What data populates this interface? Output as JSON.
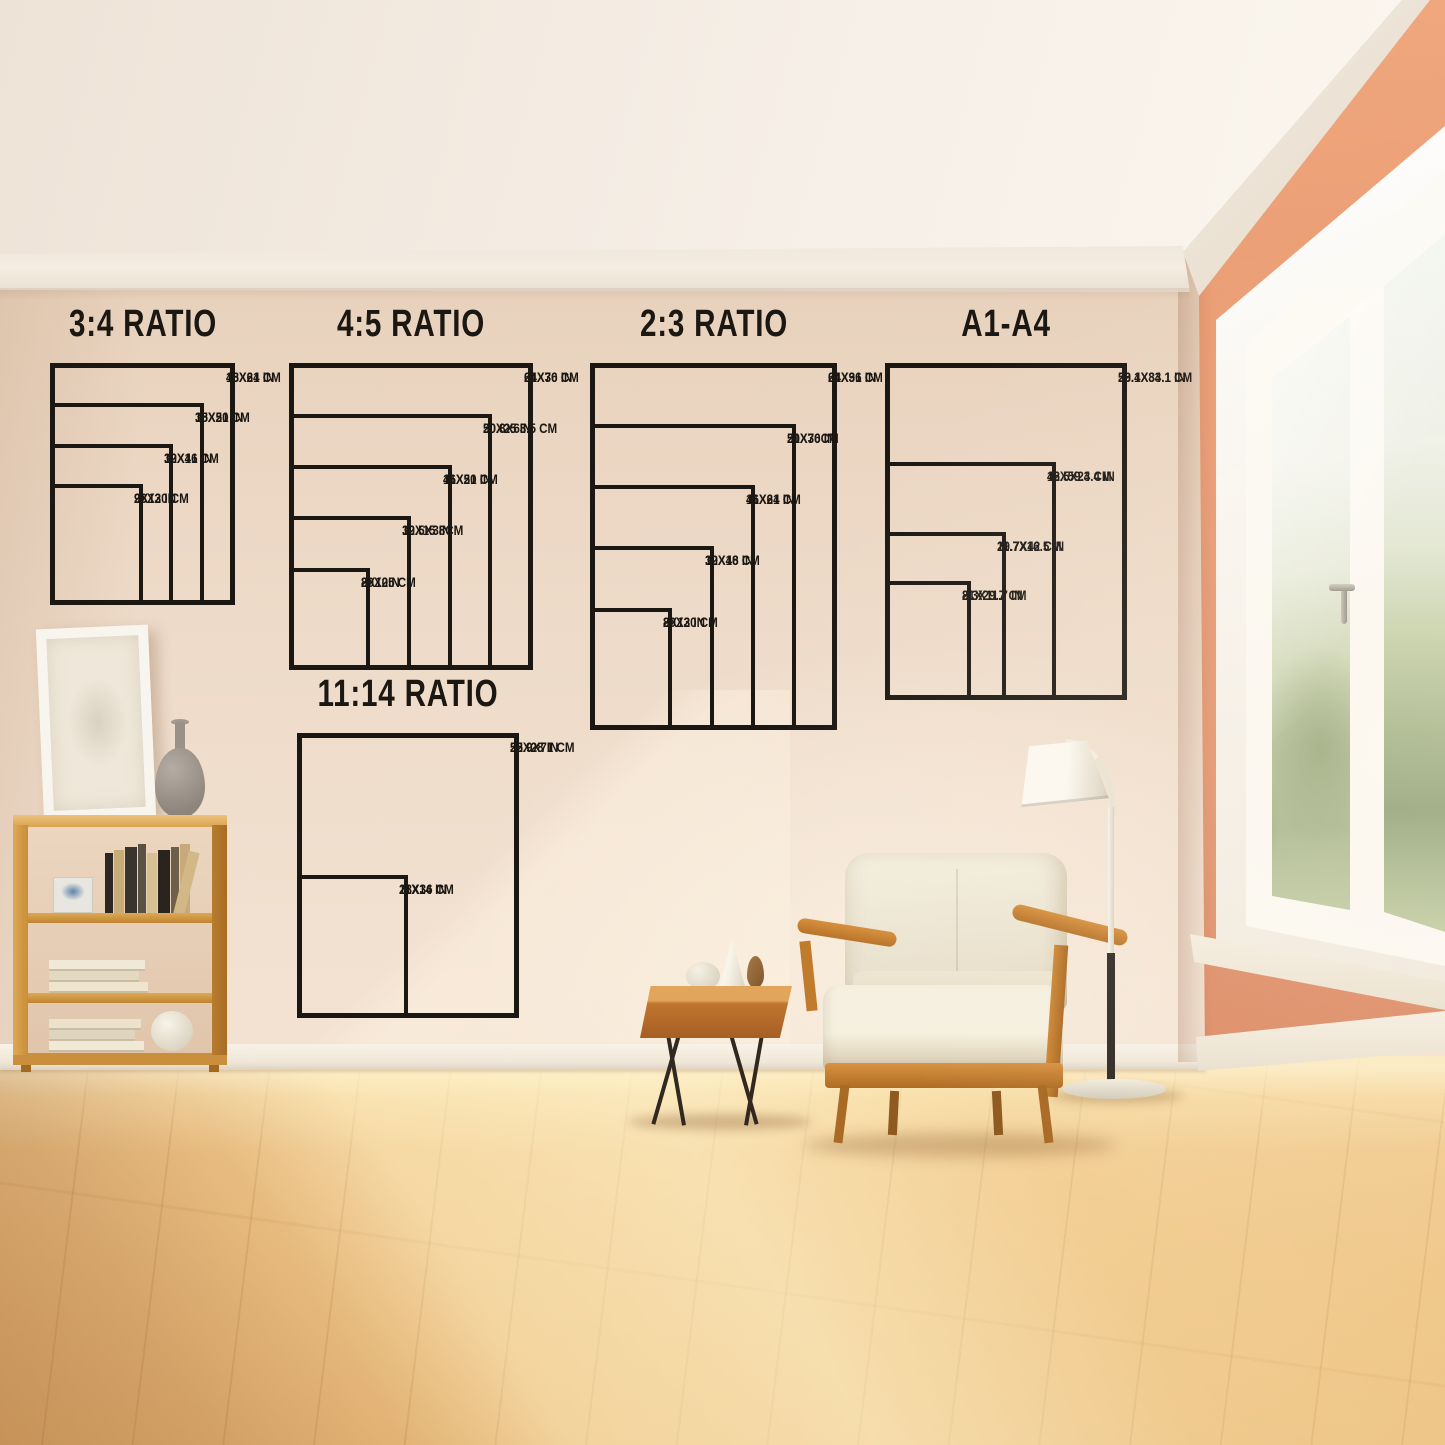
{
  "page_type": "poster-size-guide-room-mockup",
  "colors": {
    "ink": "#1b1713",
    "wall_cream": "#eedbc9",
    "wall_peach": "#e89a72",
    "floor_wood": "#edc287",
    "furniture_wood": "#c9812f",
    "cushion": "#f2ecdc",
    "window_green": "#a9b88e"
  },
  "chart_data": [
    {
      "type": "nested-size-diagram",
      "title": "3:4 RATIO",
      "sizes": [
        {
          "label_in": "18X24 IN",
          "label_cm": "46X61 CM",
          "w": 18,
          "h": 24
        },
        {
          "label_in": "15X20 IN",
          "label_cm": "38X51 CM",
          "w": 15,
          "h": 20
        },
        {
          "label_in": "12X16 IN",
          "label_cm": "30X41 CM",
          "w": 12,
          "h": 16
        },
        {
          "label_in": "9X12 IN",
          "label_cm": "23X30 CM",
          "w": 9,
          "h": 12
        }
      ]
    },
    {
      "type": "nested-size-diagram",
      "title": "4:5 RATIO",
      "sizes": [
        {
          "label_in": "24X30 IN",
          "label_cm": "61X76 CM",
          "w": 24,
          "h": 30
        },
        {
          "label_in": "20X25 IN",
          "label_cm": "50.8X63.5 CM",
          "w": 20,
          "h": 25
        },
        {
          "label_in": "16X20 IN",
          "label_cm": "41X51 CM",
          "w": 16,
          "h": 20
        },
        {
          "label_in": "12X15 IN",
          "label_cm": "30.5X38CM",
          "w": 12,
          "h": 15
        },
        {
          "label_in": "8X10IN",
          "label_cm": "20X25 CM",
          "w": 8,
          "h": 10
        }
      ]
    },
    {
      "type": "nested-size-diagram",
      "title": "2:3 RATIO",
      "sizes": [
        {
          "label_in": "24X36 IN",
          "label_cm": "61X91 CM",
          "w": 24,
          "h": 36
        },
        {
          "label_in": "20X30 IN",
          "label_cm": "51X76CM",
          "w": 20,
          "h": 30
        },
        {
          "label_in": "16X24 IN",
          "label_cm": "41X61 CM",
          "w": 16,
          "h": 24
        },
        {
          "label_in": "12X18 IN",
          "label_cm": "30X46 CM",
          "w": 12,
          "h": 18
        },
        {
          "label_in": "8X12 IN",
          "label_cm": "20X30 CM",
          "w": 8,
          "h": 12
        }
      ]
    },
    {
      "type": "nested-size-diagram",
      "title": "A1-A4",
      "sizes": [
        {
          "label_in": "23.4X33.1 IN",
          "label_cm": "59.1X84.1 CM",
          "w": 23.4,
          "h": 33.1
        },
        {
          "label_in": "16.5X23.4 IN",
          "label_cm": "42X59.4 CM",
          "w": 16.5,
          "h": 23.4
        },
        {
          "label_in": "11.7X16.5 IN",
          "label_cm": "29.7X42 CM",
          "w": 11.7,
          "h": 16.5
        },
        {
          "label_in": "8.3X11.7 IN",
          "label_cm": "21X29.7 CM",
          "w": 8.3,
          "h": 11.7
        }
      ]
    },
    {
      "type": "nested-size-diagram",
      "title": "11:14 RATIO",
      "sizes": [
        {
          "label_in": "22X28 IN",
          "label_cm": "55.9X71 CM",
          "w": 22,
          "h": 28
        },
        {
          "label_in": "11X14 IN",
          "label_cm": "28X36 CM",
          "w": 11,
          "h": 14
        }
      ]
    }
  ]
}
